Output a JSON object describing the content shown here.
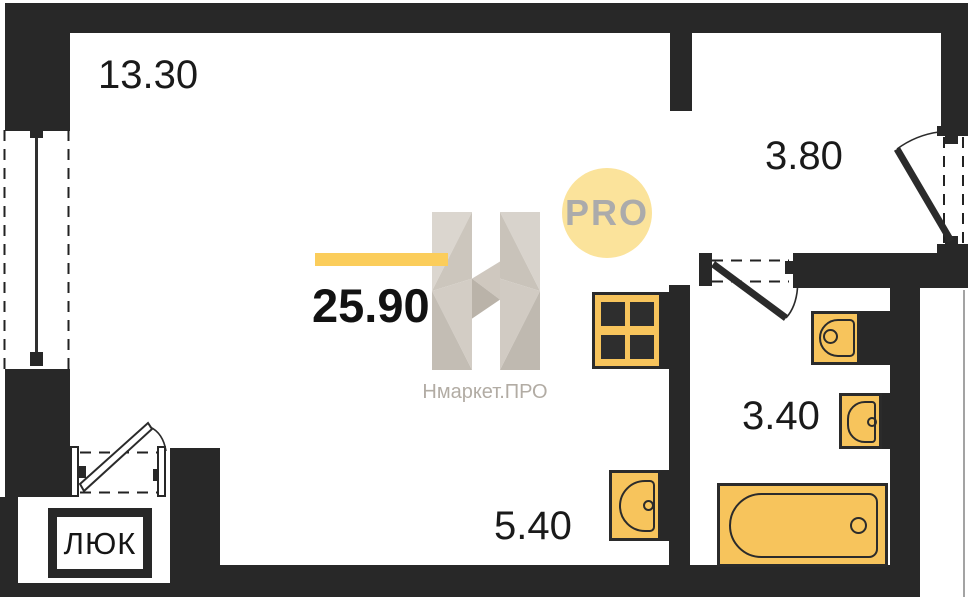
{
  "floorplan": {
    "areas": {
      "living": "13.30",
      "hall": "3.80",
      "bathroom": "3.40",
      "kitchen": "5.40",
      "total": "25.90"
    },
    "hatch_label": "ЛЮК",
    "watermark": {
      "pro_badge": "PRO",
      "brand": "Нмаркет.ПРО"
    },
    "fixtures": [
      "stove",
      "kitchen-sink",
      "toilet",
      "bathroom-sink",
      "bathtub"
    ],
    "colors": {
      "wall": "#282828",
      "fixture_fill": "#F7C45C",
      "fixture_stroke": "#2B2B2B",
      "accent_bar": "#FBCD5B",
      "pro_circle_fill": "#FBE39B",
      "pro_text": "#ABABAB",
      "brand_text": "#B2ACA4",
      "label_text": "#1A1A1A"
    }
  }
}
